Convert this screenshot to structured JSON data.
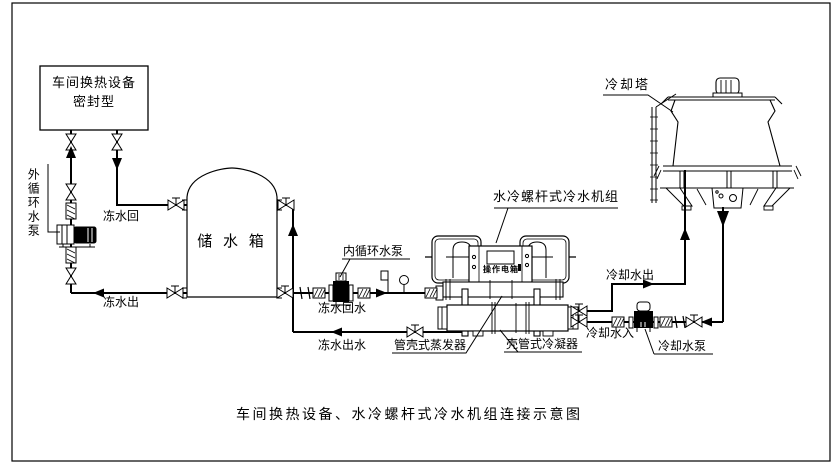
{
  "diagram": {
    "caption": "车间换热设备、水冷螺杆式冷水机组连接示意图",
    "colors": {
      "line": "#000000",
      "background": "#ffffff"
    },
    "labels": {
      "workshop_line1": "车间换热设备",
      "workshop_line2": "密封型",
      "external_pump": "外循环水泵",
      "chilled_return": "冻水回",
      "chilled_out": "冻水出",
      "tank": "储 水 箱",
      "internal_pump": "内循环水泵",
      "chilled_return_water": "冻水回水",
      "chilled_out_water": "冻水出水",
      "chiller_unit": "水冷螺杆式冷水机组",
      "control_box": "操作电箱",
      "evaporator": "管壳式蒸发器",
      "condenser": "壳管式冷凝器",
      "cooling_tower": "冷却塔",
      "cooling_water_out": "冷却水出",
      "cooling_water_in": "冷却水入",
      "cooling_pump": "冷却水泵"
    }
  }
}
